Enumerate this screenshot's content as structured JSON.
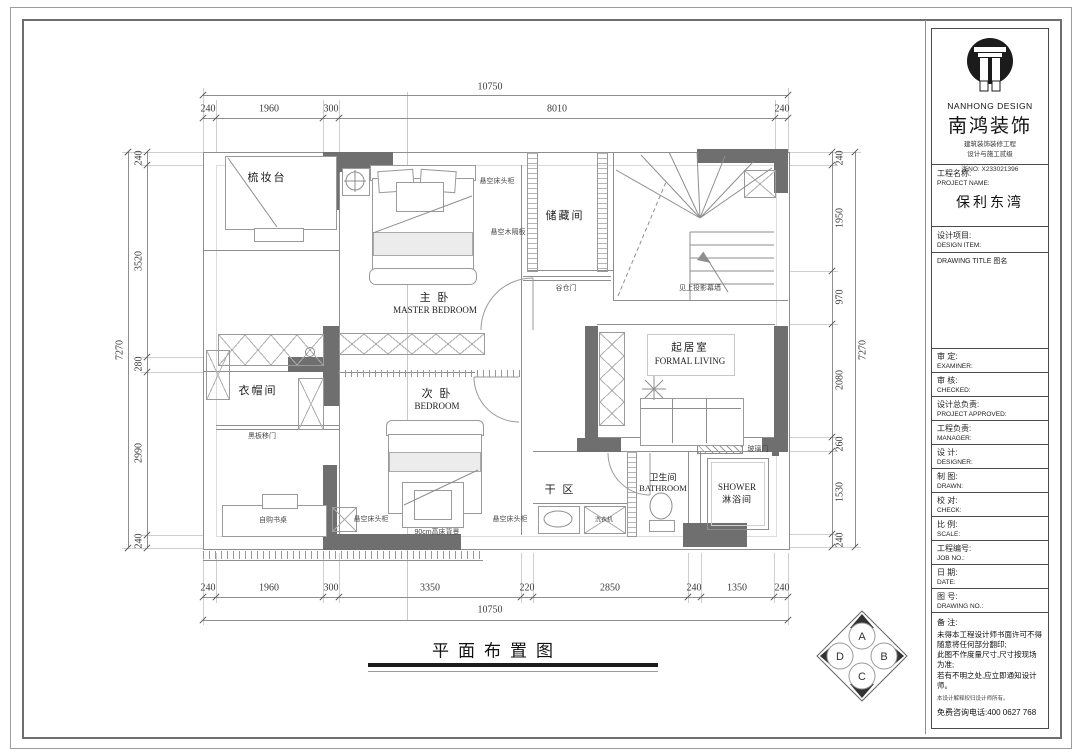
{
  "title_block": {
    "brand": {
      "logo_en": "NANHONG DESIGN",
      "logo_cn": "南鸿装饰",
      "line1": "建筑装饰装修工程",
      "line2": "设计与施工贰级",
      "cert_no": "浙NO: X233021396"
    },
    "project": {
      "label_cn": "工程名称:",
      "label_en": "PROJECT NAME:",
      "value": "保利东湾"
    },
    "design_item": {
      "label_cn": "设计项目:",
      "label_en": "DESIGN ITEM:"
    },
    "drawing_title_label": "DRAWING TITLE 图名",
    "rows": [
      {
        "cn": "审  定:",
        "en": "EXAMINER:"
      },
      {
        "cn": "审  核:",
        "en": "CHECKED:"
      },
      {
        "cn": "设计总负责:",
        "en": "PROJECT APPROVED:"
      },
      {
        "cn": "工程负责:",
        "en": "MANAGER:"
      },
      {
        "cn": "设  计:",
        "en": "DESIGNER:"
      },
      {
        "cn": "制  图:",
        "en": "DRAWN:"
      },
      {
        "cn": "校  对:",
        "en": "CHECK:"
      },
      {
        "cn": "比  例:",
        "en": "SCALE:"
      },
      {
        "cn": "工程编号:",
        "en": "JOB NO.:"
      },
      {
        "cn": "日  期:",
        "en": "DATE:"
      },
      {
        "cn": "图  号:",
        "en": "DRAWING NO.:"
      }
    ],
    "notes": {
      "label": "备 注:",
      "items": [
        "未得本工程设计师书面许可不得随意将任何部分翻印;",
        "此图不作度量尺寸,尺寸按现场为准;",
        "若有不明之处,应立即通知设计师。"
      ],
      "disclaimer": "本设计解释权归设计师所有。",
      "hotline": "免费咨询电话:400 0627 768"
    }
  },
  "dimensions": {
    "top": {
      "total": "10750",
      "segments": [
        "240",
        "1960",
        "300",
        "8010",
        "240"
      ]
    },
    "bottom": {
      "total": "10750",
      "segments": [
        "240",
        "1960",
        "300",
        "3350",
        "220",
        "2850",
        "240",
        "1350",
        "240"
      ]
    },
    "left": {
      "total": "7270",
      "segments": [
        "240",
        "3520",
        "280",
        "2990",
        "240"
      ]
    },
    "right": {
      "total": "7270",
      "segments": [
        "240",
        "1950",
        "970",
        "2080",
        "260",
        "1530",
        "240"
      ]
    }
  },
  "plan": {
    "caption": "平面布置图",
    "rooms": {
      "dressing": {
        "cn": "梳妆台"
      },
      "master": {
        "cn": "主 卧",
        "en": "MASTER BEDROOM"
      },
      "storage": {
        "cn": "储藏间"
      },
      "cloak": {
        "cn": "衣帽间"
      },
      "bedroom": {
        "cn": "次 卧",
        "en": "BEDROOM"
      },
      "living": {
        "cn": "起居室",
        "en": "FORMAL LIVING"
      },
      "dry": {
        "cn": "干 区"
      },
      "bath": {
        "cn": "卫生间",
        "en": "BATHROOM"
      },
      "shower": {
        "en": "SHOWER",
        "cn": "淋浴间"
      }
    },
    "annotations": {
      "nightstand_master": "悬空床头柜",
      "wood_shelf": "悬空木隔板",
      "barn_door": "谷仓门",
      "projection_wall": "见上投影幕墙",
      "blackboard_door": "黑板移门",
      "desk": "自购书桌",
      "nightstand_left": "悬空床头柜",
      "bed_backdrop": "90cm高床背景",
      "nightstand_right": "悬空床头柜",
      "washer": "洗衣机",
      "glass_door": "玻璃门"
    },
    "compass": {
      "top": "A",
      "right": "B",
      "bottom": "C",
      "left": "D"
    },
    "colors": {
      "wall": "#6f6f6f",
      "line": "#8e8e8e",
      "ink": "#1e1e1e"
    }
  }
}
